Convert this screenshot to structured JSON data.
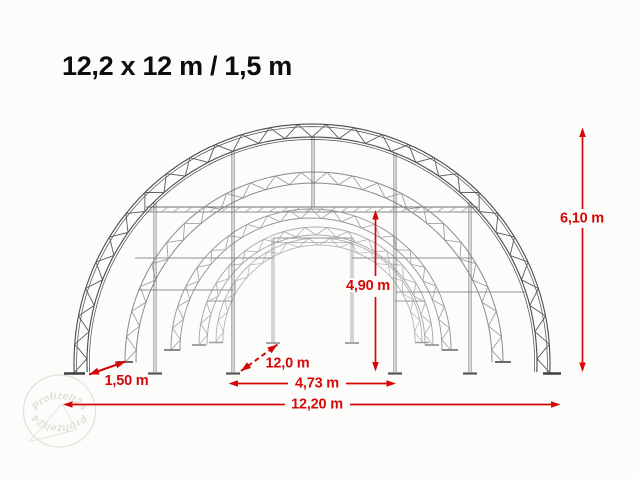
{
  "title": "12,2 x 12 m / 1,5 m",
  "diagram": {
    "type": "tent-frame-dimension-drawing",
    "dimensions": {
      "total_height": "6,10 m",
      "clear_height": "4,90 m",
      "arch_spacing": "1,50 m",
      "length": "12,0 m",
      "door_width": "4,73 m",
      "total_width": "12,20 m"
    }
  },
  "watermark": {
    "brand": "Profizelt24"
  },
  "colors": {
    "dimension_red": "#d40808",
    "structure_dark": "#4a4a4a",
    "structure_light": "#b0b0b0",
    "title_text": "#0d0d0d",
    "background": "#fcfcfb",
    "watermark_tint": "#e0ddd5"
  }
}
